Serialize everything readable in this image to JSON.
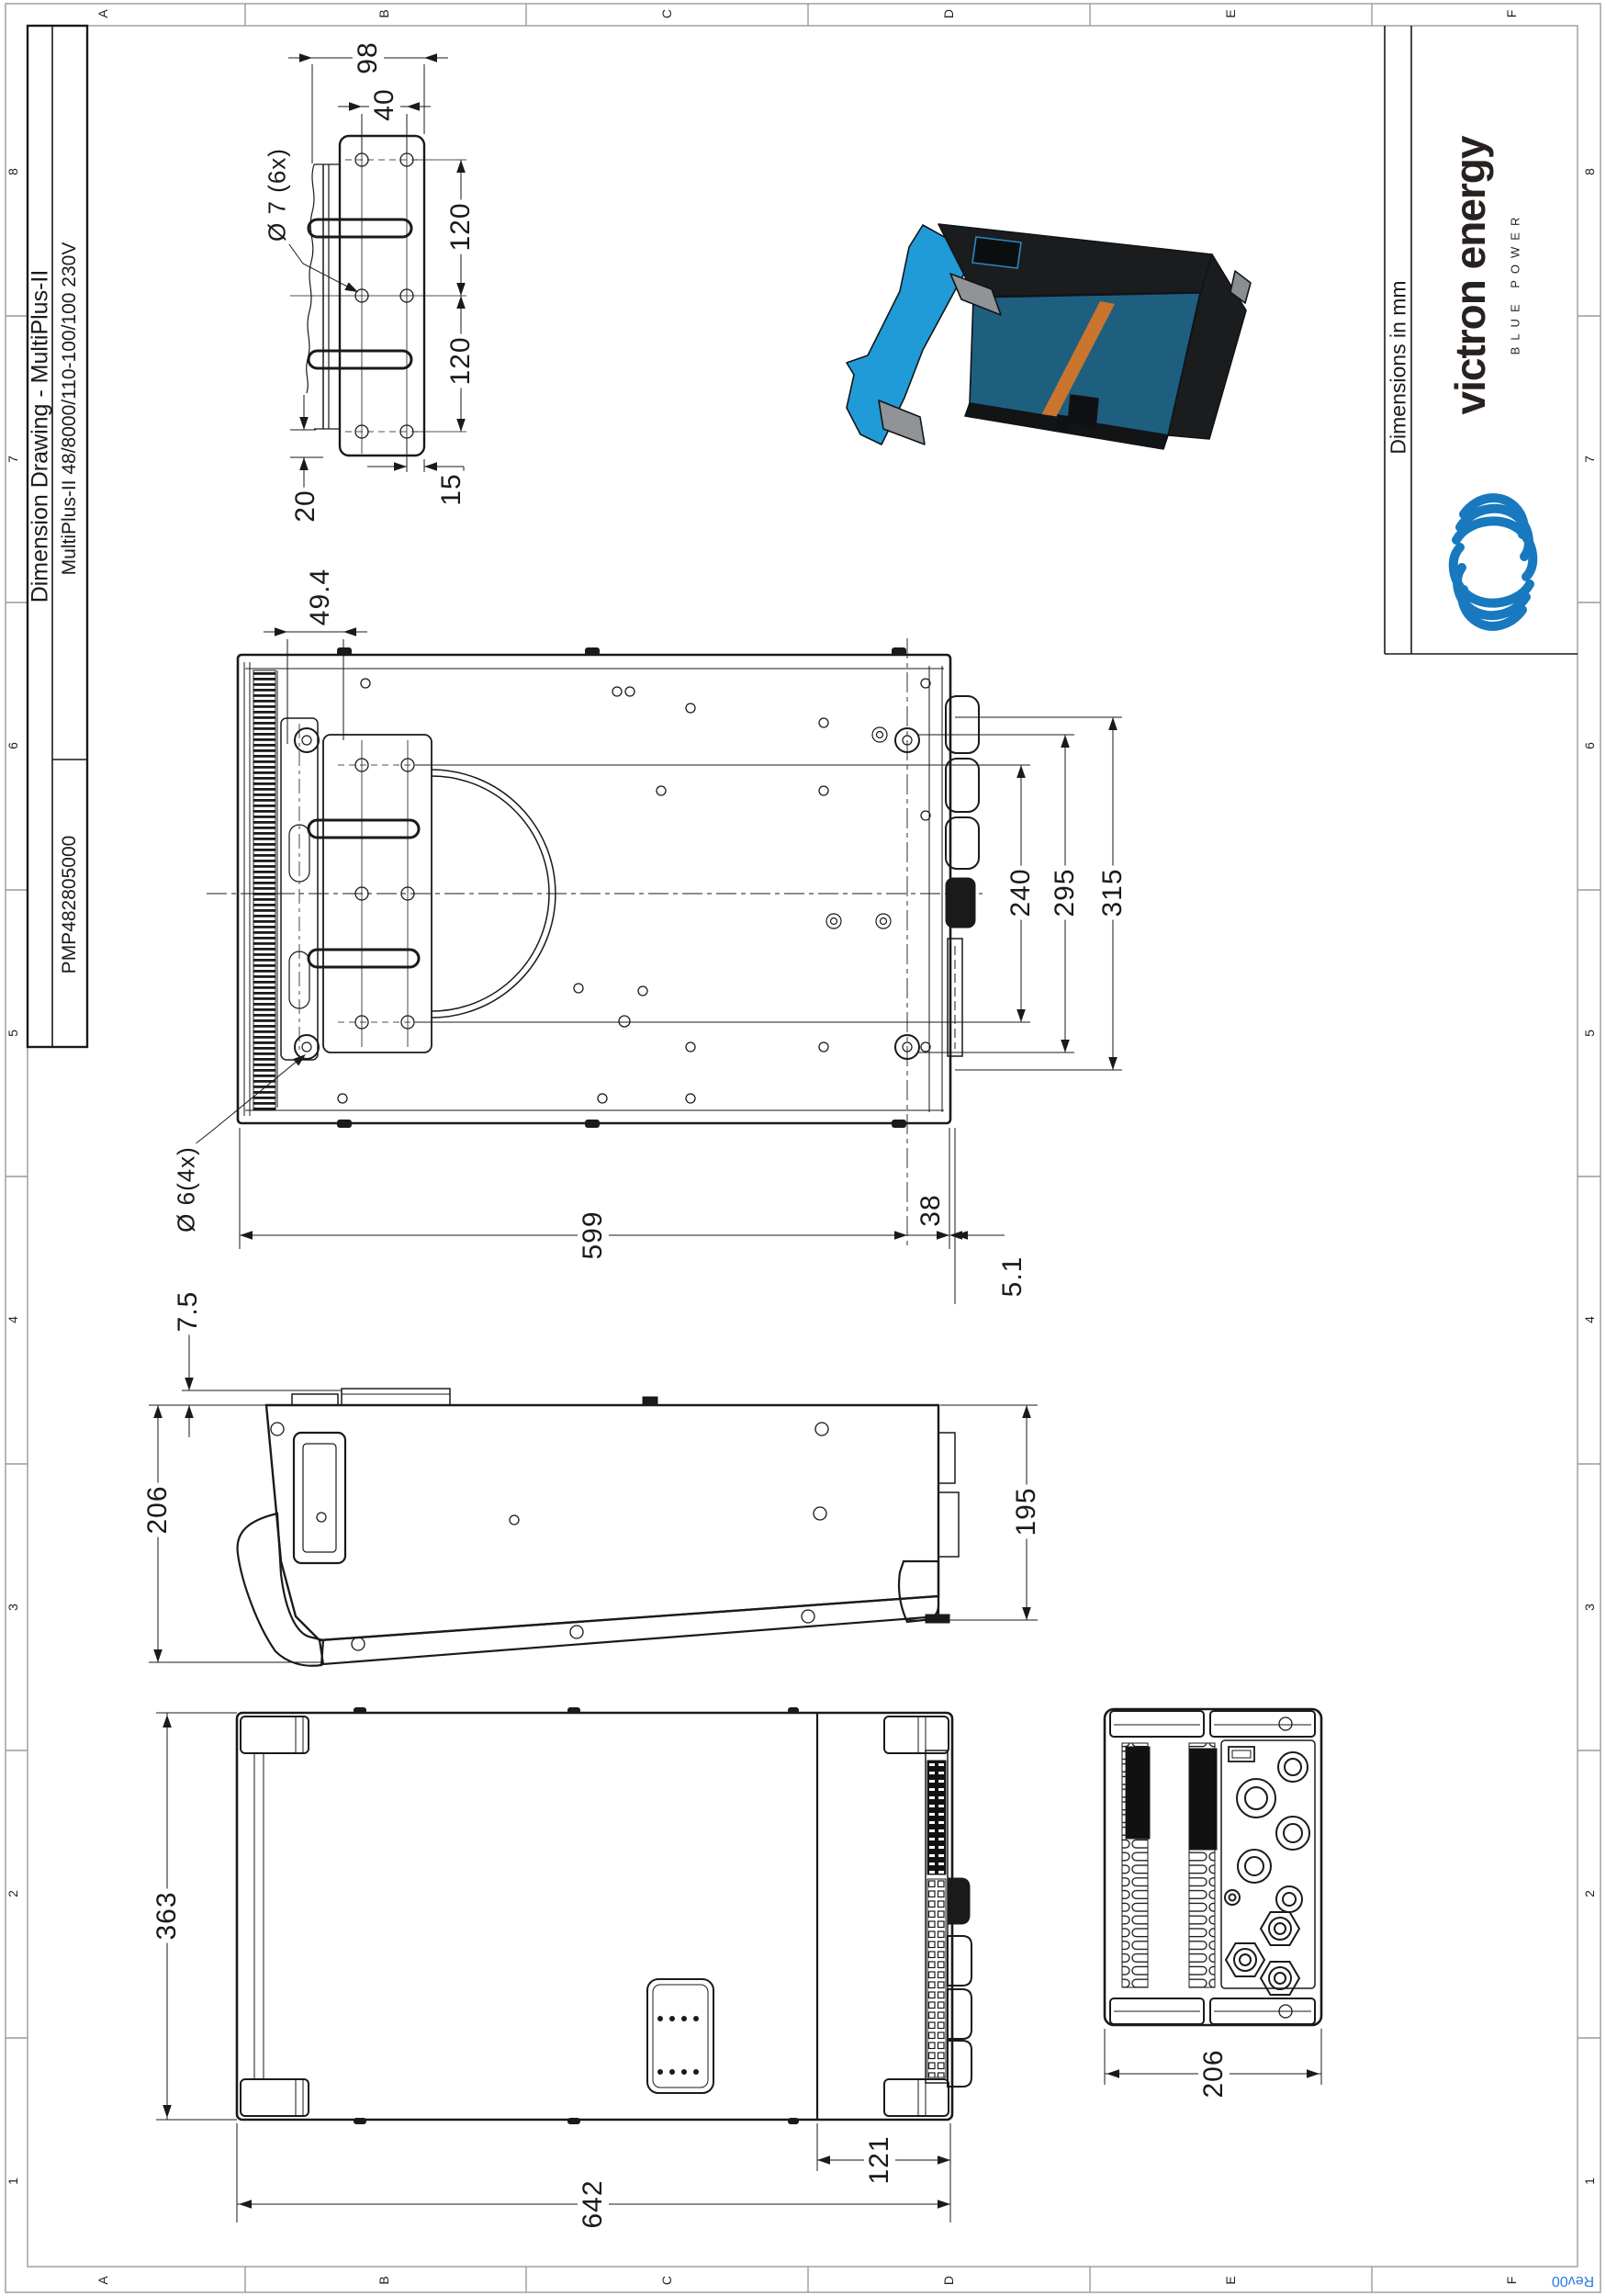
{
  "sheet": {
    "grid_letters": [
      "A",
      "B",
      "C",
      "D",
      "E",
      "F"
    ],
    "grid_numbers": [
      "8",
      "7",
      "6",
      "5",
      "4",
      "3",
      "2",
      "1"
    ],
    "revision": "Rev00"
  },
  "title_block": {
    "drawing_title": "Dimension Drawing - MultiPlus-II",
    "model": "MultiPlus-II 48/8000/110-100/100 230V",
    "part_number": "PMP482805000"
  },
  "branding": {
    "units_note": "Dimensions in mm",
    "brand_name": "victron energy",
    "tagline": "BLUE POWER",
    "brand_blue": "#1879BF",
    "revision_blue": "#2E7BDE"
  },
  "dimensions": {
    "bracket_detail": {
      "width": "98",
      "hole_pitch_x": "40",
      "hole_callout": "Ø 7 (6x)",
      "hole_pitch_y_upper": "120",
      "hole_pitch_y_lower": "120",
      "bottom_offset": "20",
      "side_offset": "15"
    },
    "rear_view": {
      "bracket_offset": "49.4",
      "hole_span": "240",
      "inner_height": "295",
      "overall_height": "315",
      "body_width": "599",
      "end_cap_depth": "38",
      "flange_gap": "5.1",
      "foot_hole_callout": "Ø 6(4x)"
    },
    "side_view": {
      "wall_gap": "7.5",
      "overall_depth": "206",
      "body_depth": "195"
    },
    "front_view": {
      "overall_height": "363",
      "overall_width": "642",
      "connection_zone_width": "121"
    },
    "connection_view": {
      "overall_depth": "206"
    }
  }
}
